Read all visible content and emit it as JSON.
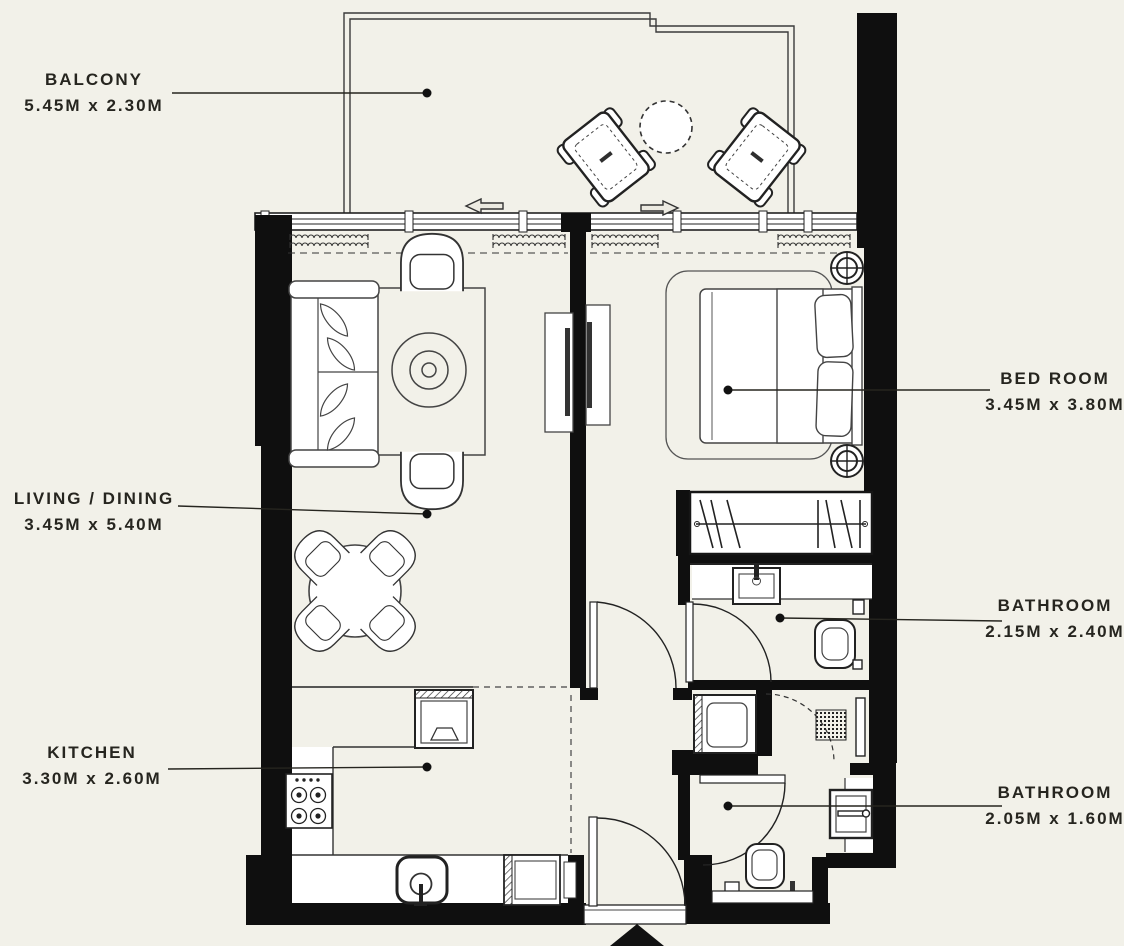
{
  "plan": {
    "type": "apartment-floor-plan",
    "colors": {
      "background": "#f2f1e9",
      "wall": "#0f0f0f",
      "line": "#2f2f2f",
      "fixture_fill": "#ffffff",
      "text": "#26251f"
    },
    "labels": {
      "balcony": {
        "name": "BALCONY",
        "dims": "5.45M x 2.30M"
      },
      "living": {
        "name": "LIVING / DINING",
        "dims": "3.45M x 5.40M"
      },
      "kitchen": {
        "name": "KITCHEN",
        "dims": "3.30M x 2.60M"
      },
      "bedroom": {
        "name": "BED ROOM",
        "dims": "3.45M x 3.80M"
      },
      "bathroom_1": {
        "name": "BATHROOM",
        "dims": "2.15M x 2.40M"
      },
      "bathroom_2": {
        "name": "BATHROOM",
        "dims": "2.05M x 1.60M"
      }
    },
    "icons": [
      "sofa-icon",
      "coffee-table-icon",
      "armchair-icon",
      "dining-table-icon",
      "dining-chair-icon",
      "tv-unit-icon",
      "double-bed-icon",
      "bedside-lamp-icon",
      "wardrobe-icon",
      "bath-sink-icon",
      "toilet-icon",
      "washing-machine-icon",
      "stove-icon",
      "kitchen-sink-icon",
      "fridge-icon",
      "dishwasher-icon",
      "balcony-chair-icon",
      "balcony-table-icon",
      "door-swing-icon",
      "entry-arrow-icon",
      "curtain-icon",
      "window-icon",
      "leader-dot-icon"
    ]
  }
}
